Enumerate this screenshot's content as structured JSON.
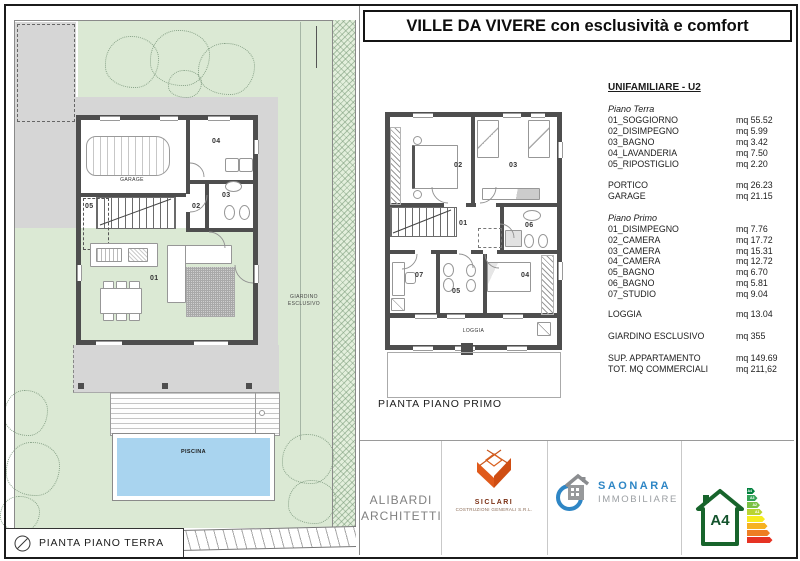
{
  "title": "VILLE DA VIVERE con esclusività e comfort",
  "site_plan": {
    "caption": "PIANTA PIANO TERRA",
    "garden_label": "GIARDINO ESCLUSIVO",
    "pool_label": "PISCINA",
    "garage_label": "GARAGE",
    "rooms": [
      "01",
      "02",
      "03",
      "04",
      "05"
    ]
  },
  "floor_plan": {
    "caption": "PIANTA PIANO PRIMO",
    "loggia_label": "LOGGIA",
    "rooms": [
      "01",
      "02",
      "03",
      "04",
      "05",
      "06",
      "07"
    ]
  },
  "table": {
    "header": "UNIFAMILIARE - U2",
    "ground": {
      "section": "Piano Terra",
      "rows": [
        {
          "label": "01_SOGGIORNO",
          "value": "mq 55.52"
        },
        {
          "label": "02_DISIMPEGNO",
          "value": "mq 5.99"
        },
        {
          "label": "03_BAGNO",
          "value": "mq 3.42"
        },
        {
          "label": "04_LAVANDERIA",
          "value": "mq 7.50"
        },
        {
          "label": "05_RIPOSTIGLIO",
          "value": "mq 2.20"
        }
      ],
      "extra": [
        {
          "label": "PORTICO",
          "value": "mq 26.23"
        },
        {
          "label": "GARAGE",
          "value": "mq 21.15"
        }
      ]
    },
    "first": {
      "section": "Piano Primo",
      "rows": [
        {
          "label": "01_DISIMPEGNO",
          "value": "mq 7.76"
        },
        {
          "label": "02_CAMERA",
          "value": "mq 17.72"
        },
        {
          "label": "03_CAMERA",
          "value": "mq 15.31"
        },
        {
          "label": "04_CAMERA",
          "value": "mq 12.72"
        },
        {
          "label": "05_BAGNO",
          "value": "mq 6.70"
        },
        {
          "label": "06_BAGNO",
          "value": "mq 5.81"
        },
        {
          "label": "07_STUDIO",
          "value": "mq 9.04"
        }
      ],
      "extra": [
        {
          "label": "LOGGIA",
          "value": "mq 13.04"
        },
        {
          "label": "GIARDINO ESCLUSIVO",
          "value": "mq 355"
        },
        {
          "label": "SUP. APPARTAMENTO",
          "value": "mq 149.69"
        },
        {
          "label": "TOT. MQ COMMERCIALI",
          "value": "mq 211,62"
        }
      ]
    }
  },
  "logos": {
    "architect": {
      "line1": "ALIBARDI",
      "line2": "ARCHITETTI"
    },
    "builder": {
      "name": "SICLARI",
      "subtitle": "COSTRUZIONI GENERALI S.R.L."
    },
    "agency": {
      "name": "SAONARA",
      "subtitle": "IMMOBILIARE"
    },
    "energy": {
      "class": "A4",
      "scale": [
        "A4",
        "A3",
        "A2",
        "A1"
      ],
      "bar_colors": [
        "#00803d",
        "#33a357",
        "#7ac143",
        "#b9d432",
        "#f7ec1f",
        "#f6b221",
        "#ee7e23",
        "#e63323"
      ]
    }
  },
  "colors": {
    "garden": "#dbe9d4",
    "path": "#d6d6d6",
    "wall": "#4e4e4e",
    "pool": "#a9d4ef",
    "siclari": "#e05a1b",
    "saonara": "#2e86c5",
    "energy": "#17642b"
  }
}
